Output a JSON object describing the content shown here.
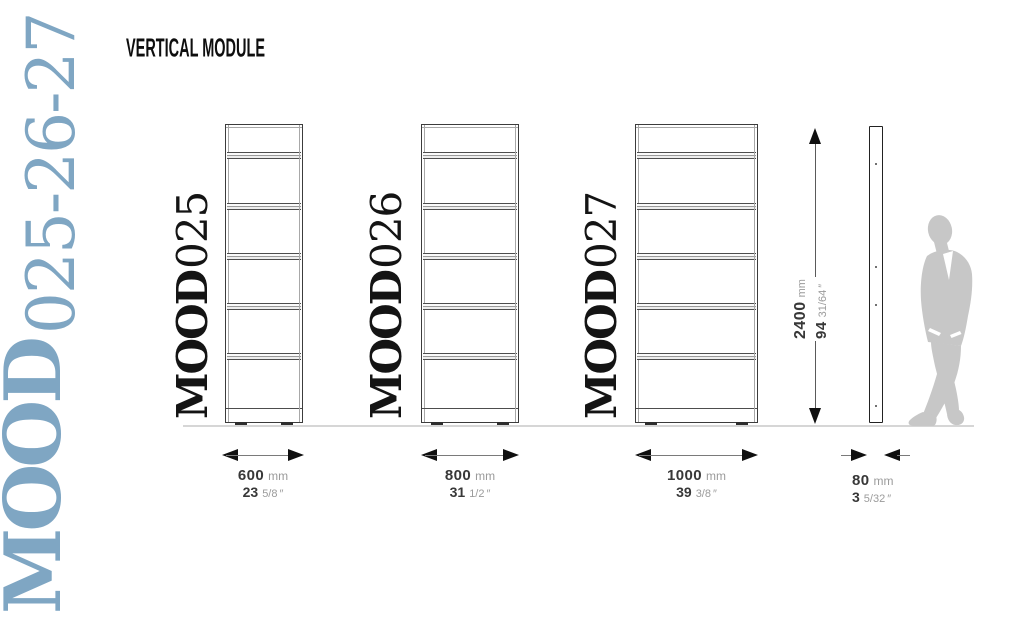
{
  "page_title": "VERTICAL MODULE",
  "brand": {
    "serif": "MOOD",
    "numbers": "025-26-27"
  },
  "units": [
    {
      "label_serif": "MOOD",
      "label_number": "025",
      "width_value": "600",
      "width_unit": "mm",
      "inch_value": "23",
      "inch_fraction": "5/8",
      "inch_mark": "″"
    },
    {
      "label_serif": "MOOD",
      "label_number": "026",
      "width_value": "800",
      "width_unit": "mm",
      "inch_value": "31",
      "inch_fraction": "1/2",
      "inch_mark": "″"
    },
    {
      "label_serif": "MOOD",
      "label_number": "027",
      "width_value": "1000",
      "width_unit": "mm",
      "inch_value": "39",
      "inch_fraction": "3/8",
      "inch_mark": "″"
    }
  ],
  "height_dimension": {
    "value": "2400",
    "unit": "mm",
    "inch_value": "94",
    "inch_fraction": "31/64",
    "inch_mark": "″"
  },
  "depth_dimension": {
    "value": "80",
    "unit": "mm",
    "inch_value": "3",
    "inch_fraction": "5/32",
    "inch_mark": "″"
  },
  "colors": {
    "brand_blue": "#7fa6c3",
    "silhouette_gray": "#c7c7c7",
    "drawing_line": "#3c3c3c",
    "dim_text_dark": "#383838",
    "dim_text_gray": "#9b9b9b",
    "ground_line": "#d6d6d6"
  }
}
